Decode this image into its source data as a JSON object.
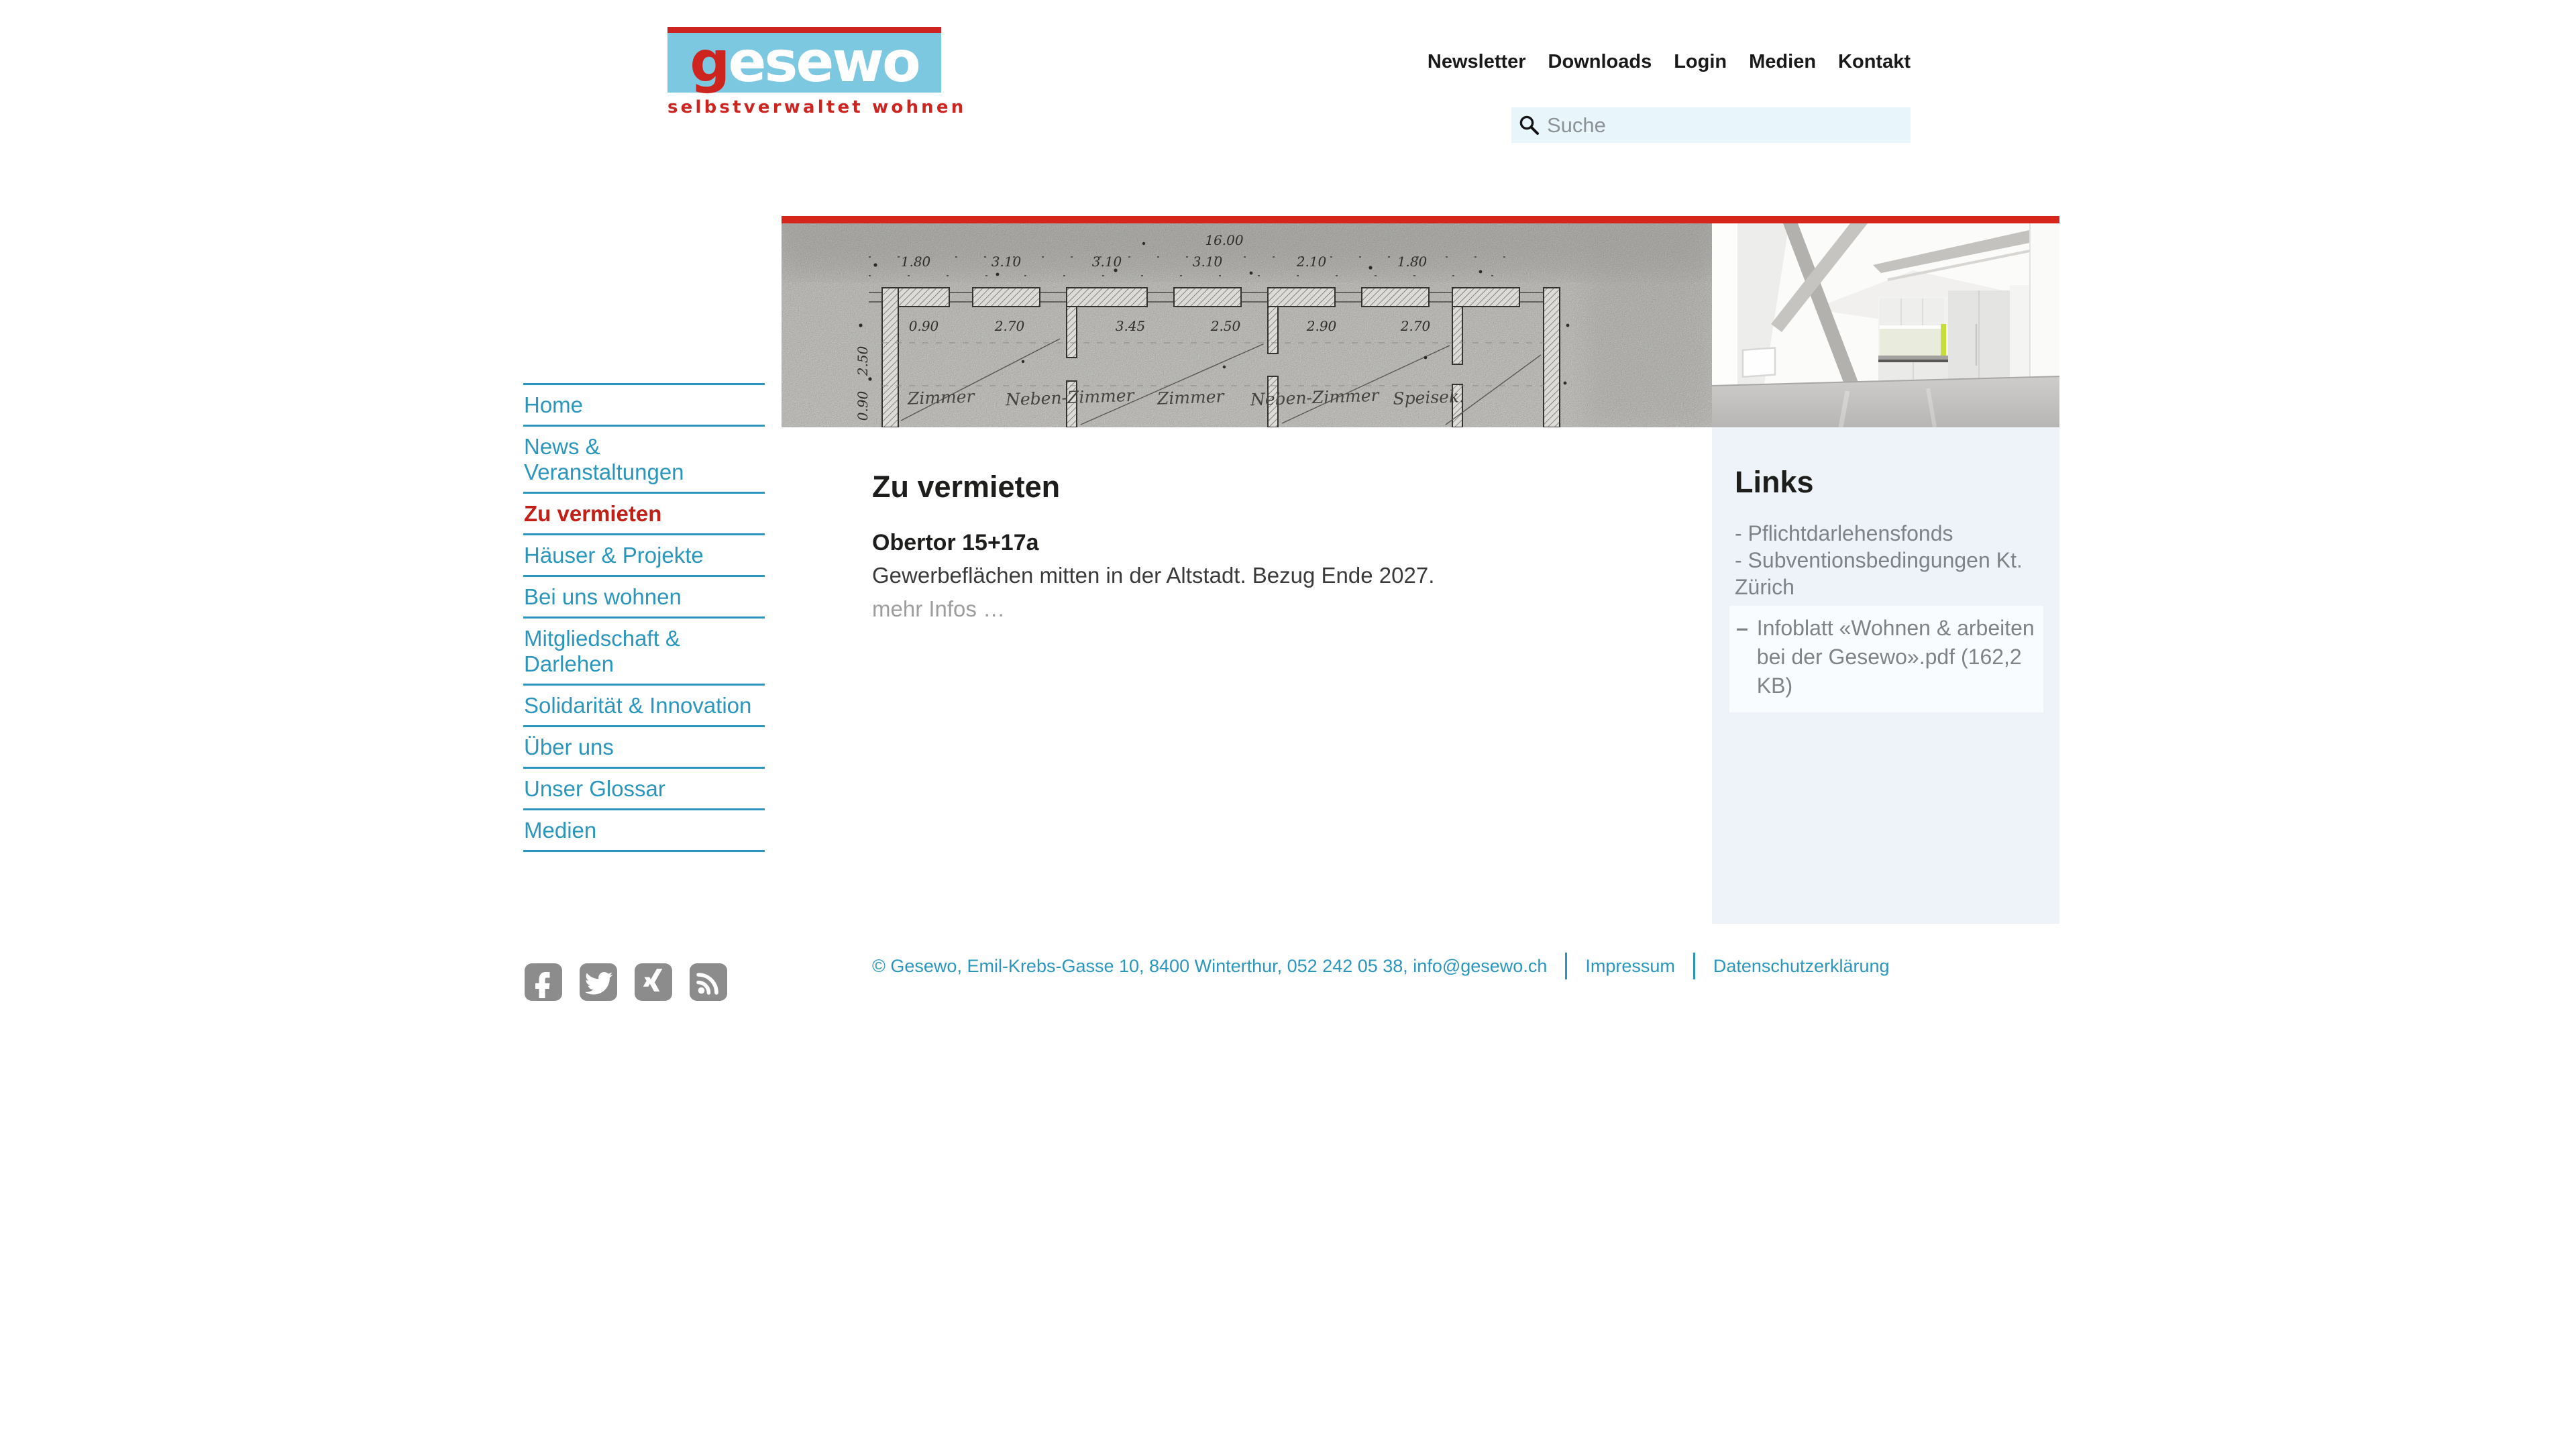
{
  "brand": {
    "logo_initial": "g",
    "logo_rest": "esewo",
    "tagline": "selbstverwaltet wohnen",
    "red": "#ce2420",
    "blue": "#7dc8e1"
  },
  "top_nav": {
    "items": [
      "Newsletter",
      "Downloads",
      "Login",
      "Medien",
      "Kontakt"
    ]
  },
  "search": {
    "placeholder": "Suche"
  },
  "sidebar": {
    "items": [
      "Home",
      "News & Veranstaltungen",
      "Zu vermieten",
      "Häuser & Projekte",
      "Bei uns wohnen",
      "Mitgliedschaft & Darlehen",
      "Solidarität & Innovation",
      "Über uns",
      "Unser Glossar",
      "Medien"
    ],
    "active_item": "Zu vermieten"
  },
  "banner": {
    "accent_color": "#d6251c",
    "blueprint": {
      "total_dim": "16.00",
      "dims_top": [
        "1.80",
        "3.10",
        "3.10",
        "3.10",
        "2.10",
        "1.80"
      ],
      "dims_mid": [
        "0.90",
        "2.70",
        "3.45",
        "2.50",
        "2.90",
        "2.70"
      ],
      "dims_left": [
        "2.50",
        "0.90"
      ],
      "room_labels": [
        "Zimmer",
        "Neben-Zimmer",
        "Zimmer",
        "Neben-Zimmer",
        "Speisek."
      ]
    }
  },
  "main": {
    "title": "Zu vermieten",
    "listing": {
      "name": "Obertor 15+17a",
      "description": "Gewerbeflächen mitten in der Altstadt. Bezug Ende 2027.",
      "more_link": "mehr Infos …"
    }
  },
  "links_panel": {
    "title": "Links",
    "items": [
      "- Pflichtdarlehensfonds",
      "- Subventionsbedingungen Kt. Zürich"
    ],
    "file_dash": "–",
    "file_label": "Infoblatt «Wohnen & arbeiten bei der Gesewo».pdf (162,2 KB)"
  },
  "footer": {
    "copyright": "© Gesewo, Emil-Krebs-Gasse 10, 8400 Winterthur, 052 242 05 38, info@gesewo.ch",
    "impressum": "Impressum",
    "datenschutz": "Datenschutzerklärung",
    "social": [
      "facebook",
      "twitter",
      "xing",
      "rss"
    ]
  },
  "colors": {
    "teal": "#2a96be",
    "active_red": "#c22017",
    "banner_red": "#d6251c",
    "panel_bg": "#edf3f9",
    "search_bg": "#e8f5fa",
    "text_dark": "#1d1d1b",
    "text_gray": "#7e8387",
    "social_gray": "#8c8c8c"
  }
}
